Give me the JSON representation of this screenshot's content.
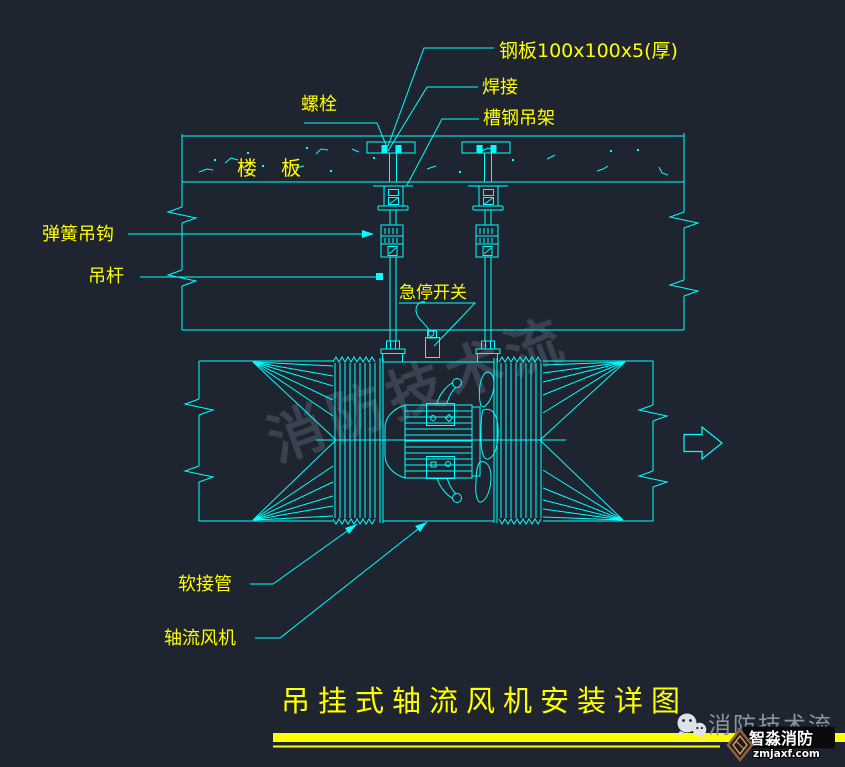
{
  "drawing": {
    "title": "吊挂式轴流风机安装详图",
    "watermark": "消防技术流",
    "annotations": {
      "steel_plate": "钢板100x100x5(厚)",
      "welding": "焊接",
      "channel_hanger": "槽钢吊架",
      "bolt": "螺栓",
      "floor_slab": "楼板",
      "spring_hook": "弹簧吊钩",
      "hanger_rod": "吊杆",
      "emergency_stop": "急停开关",
      "flexible_connector": "软接管",
      "axial_fan": "轴流风机"
    },
    "colors": {
      "background": "#1e2430",
      "line": "#00ffff",
      "label": "#ffff00",
      "title_underline": "#ffff00",
      "watermark": "#3a4250"
    }
  },
  "footer": {
    "wechat_account": "消防技术流",
    "brand_name": "智淼消防",
    "brand_domain": "zmjaxf.com"
  }
}
